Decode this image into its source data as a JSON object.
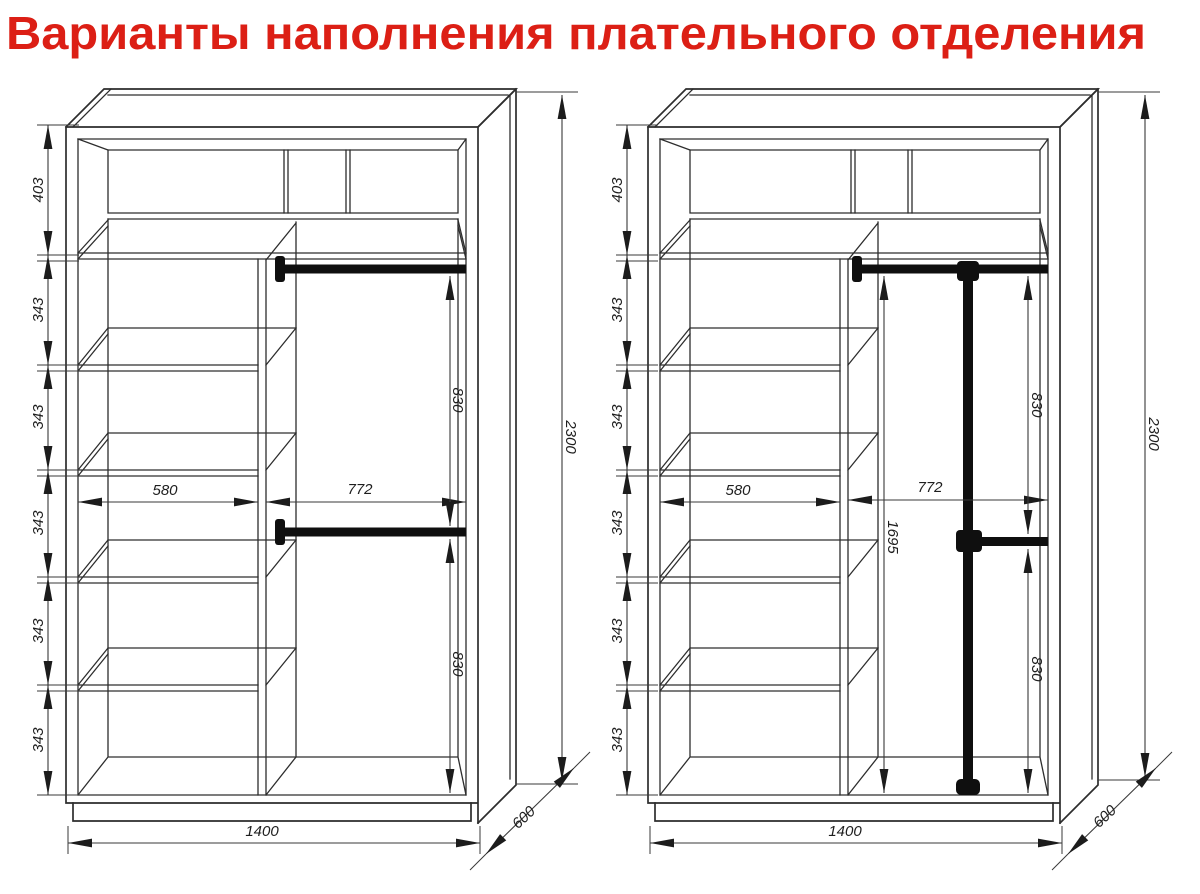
{
  "title": "Варианты наполнения плательного отделения",
  "colors": {
    "title": "#dc1f15",
    "line": "#2d2d2d",
    "dimension": "#3a3a3a",
    "rod": "#0f0f0f",
    "background": "#ffffff"
  },
  "variant1": {
    "top_compartment_height": "403",
    "shelf_spacings": [
      "343",
      "343",
      "343",
      "343",
      "343"
    ],
    "shelf_section_width": "580",
    "hanging_section_width": "772",
    "upper_hanging_drop": "830",
    "lower_hanging_drop": "830",
    "total_height": "2300",
    "total_width": "1400",
    "depth": "600"
  },
  "variant2": {
    "top_compartment_height": "403",
    "shelf_spacings": [
      "343",
      "343",
      "343",
      "343",
      "343"
    ],
    "shelf_section_width": "580",
    "hanging_section_width": "772",
    "pole_hanging_drop": "1695",
    "upper_hanging_drop": "830",
    "lower_hanging_drop": "830",
    "total_height": "2300",
    "total_width": "1400",
    "depth": "600"
  }
}
